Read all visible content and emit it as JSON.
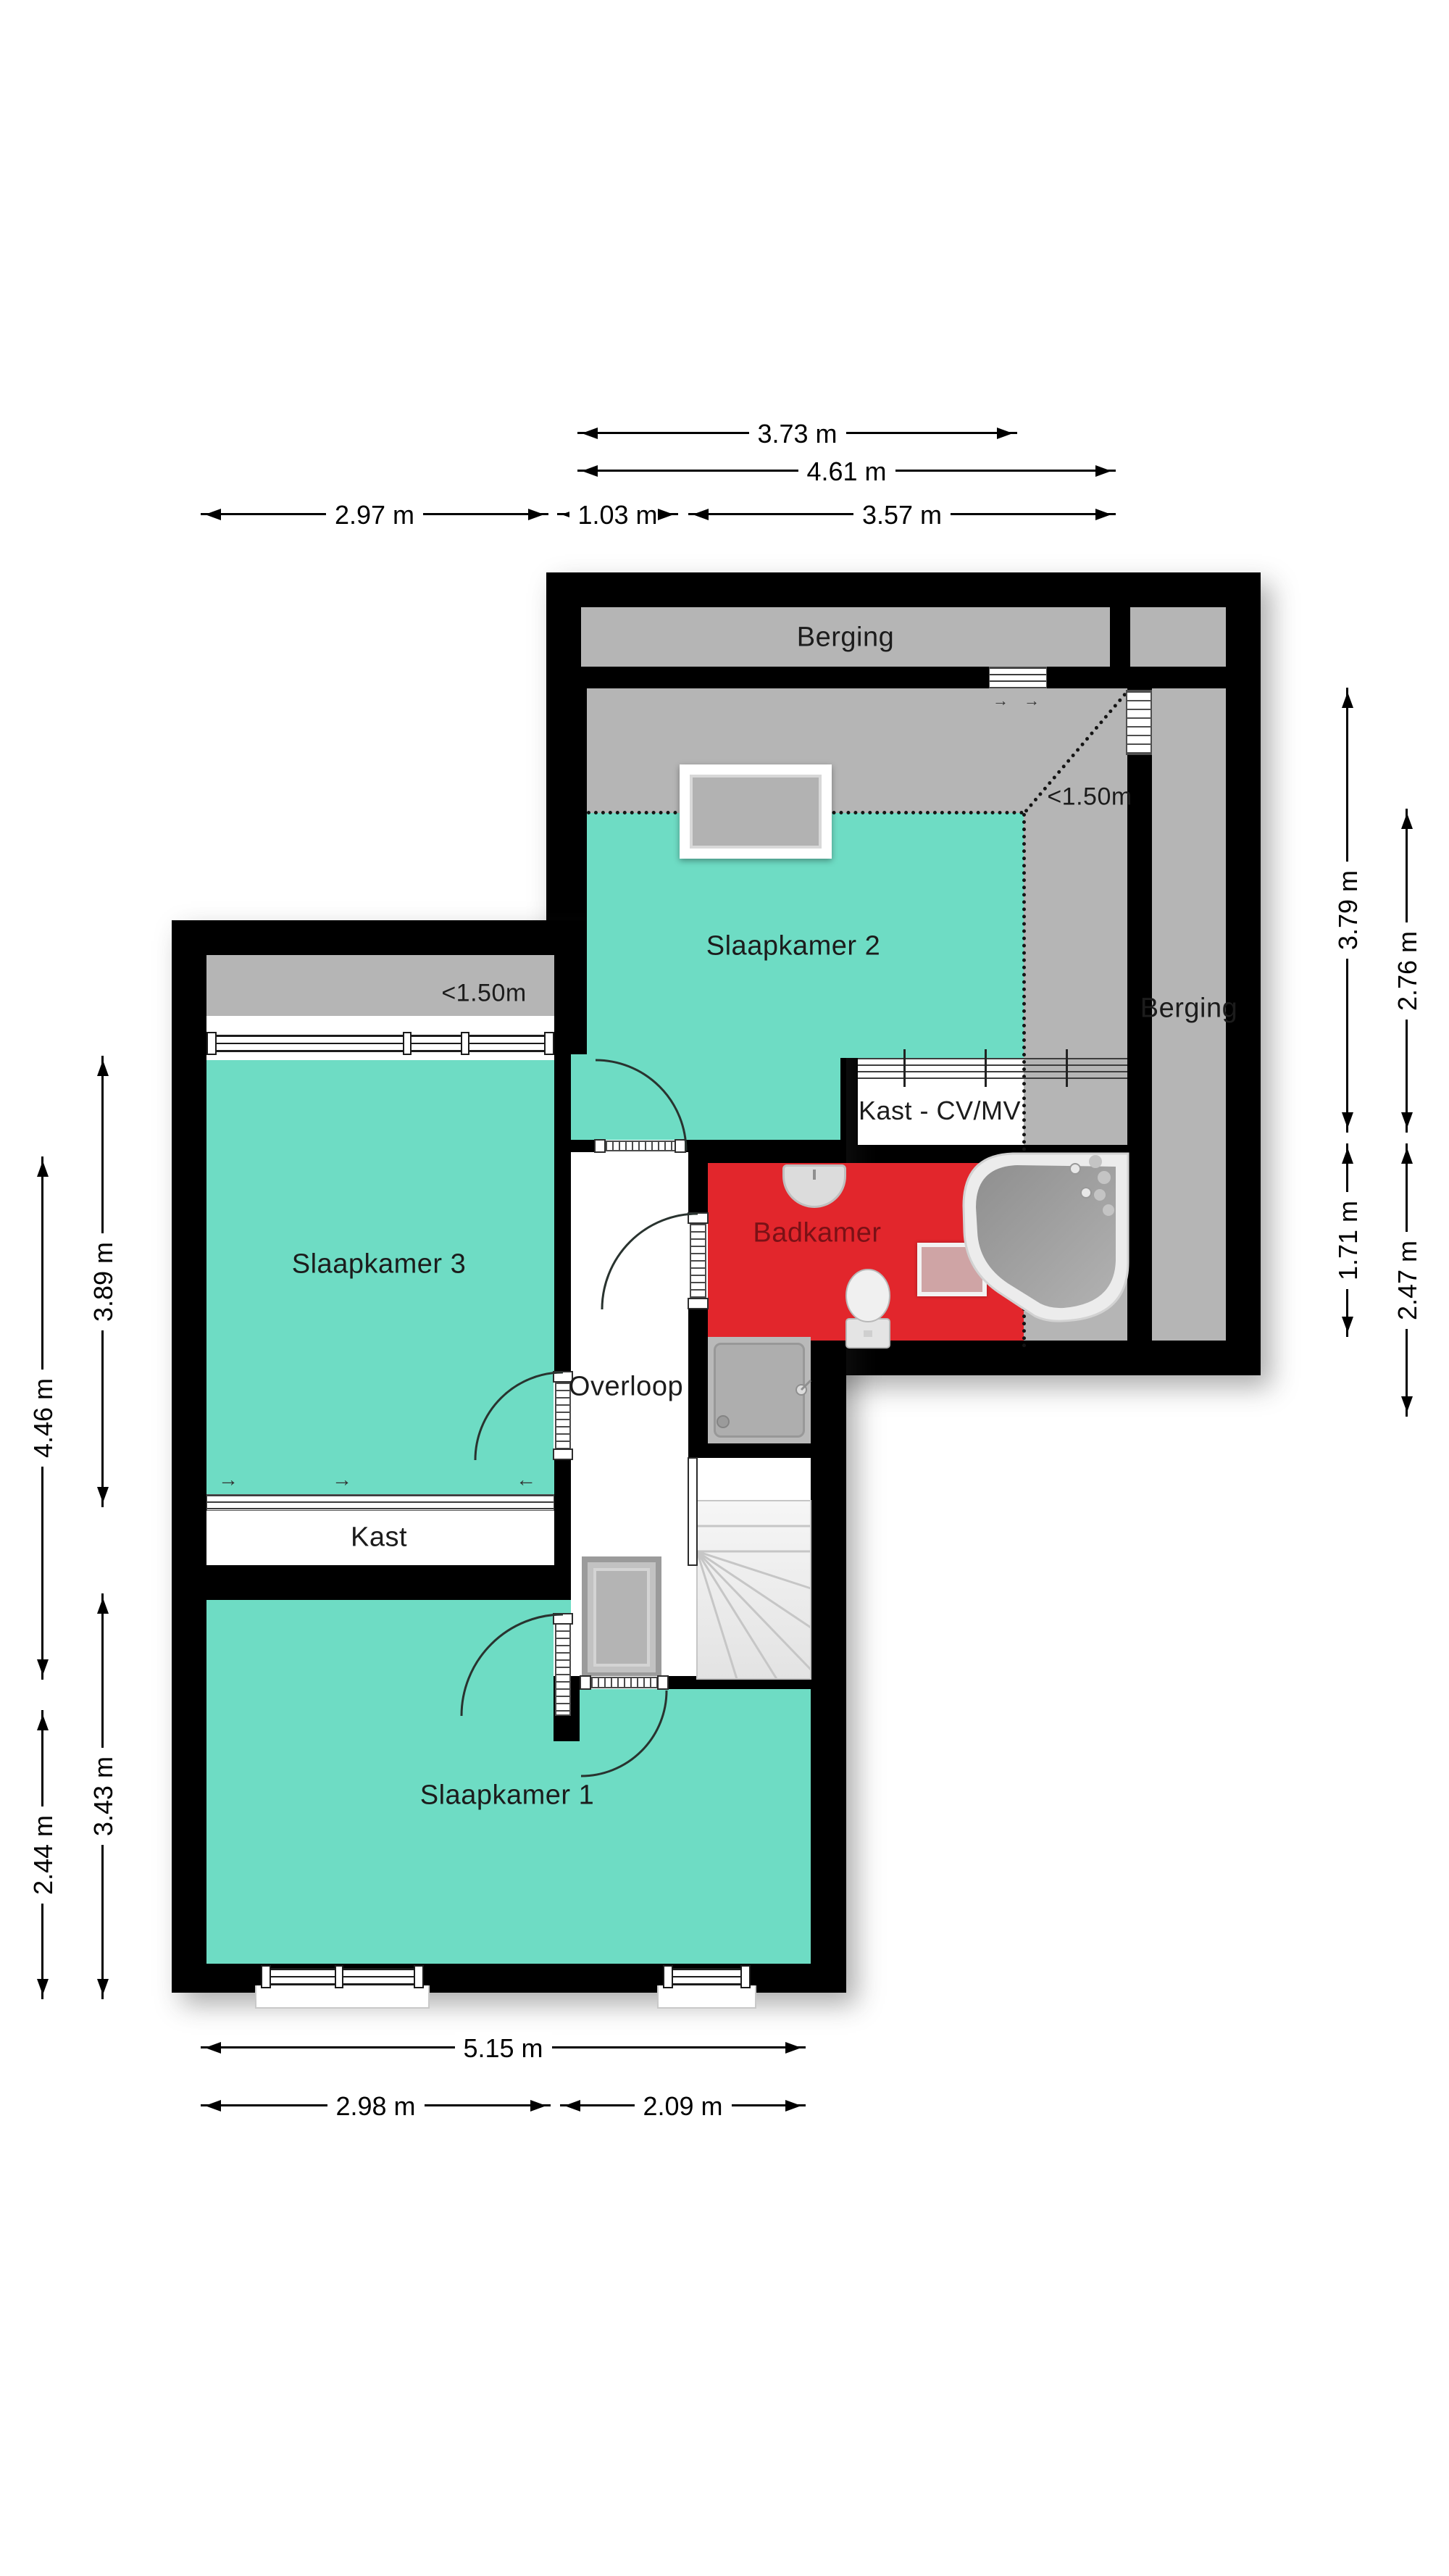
{
  "rooms": {
    "berging_top": "Berging",
    "berging_right": "Berging",
    "slaapkamer2": "Slaapkamer 2",
    "slaapkamer3": "Slaapkamer 3",
    "slaapkamer1": "Slaapkamer 1",
    "badkamer": "Badkamer",
    "overloop": "Overloop",
    "kast": "Kast",
    "kast_cv": "Kast - CV/MV"
  },
  "annotations": {
    "sk2_low_ceiling": "<1.50m",
    "sk3_low_ceiling": "<1.50m"
  },
  "dims": {
    "top_373": "3.73 m",
    "top_461": "4.61 m",
    "top_297": "2.97 m",
    "top_103": "1.03 m",
    "top_357": "3.57 m",
    "right_379": "3.79 m",
    "right_276": "2.76 m",
    "right_171": "1.71 m",
    "right_247": "2.47 m",
    "left_389": "3.89 m",
    "left_446": "4.46 m",
    "left_343": "3.43 m",
    "left_244": "2.44 m",
    "bottom_515": "5.15 m",
    "bottom_298": "2.98 m",
    "bottom_209": "2.09 m"
  },
  "icons": {
    "slide_right": "→",
    "slide_left": "←"
  },
  "colors": {
    "wall": "#000000",
    "room_teal": "#6edcc4",
    "room_gray": "#b5b5b5",
    "room_red": "#e2262c",
    "mat_pink": "#cfa4a5",
    "badkamer_label": "#7a1116"
  }
}
